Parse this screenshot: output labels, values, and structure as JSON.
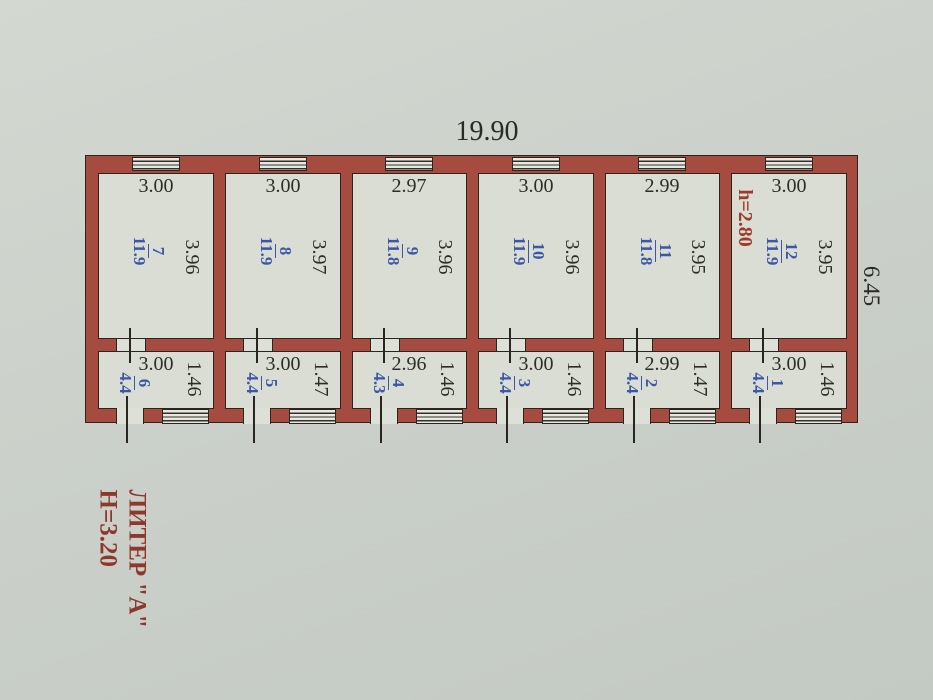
{
  "drawing": {
    "overall_width": "19.90",
    "overall_depth": "6.45",
    "ceiling_height_note": "h=2.80",
    "liter_label": "ЛИТЕР \"А\"",
    "building_height_note": "Н=3.20"
  },
  "top_rooms": [
    {
      "number": "7",
      "area": "11.9",
      "width": "3.00",
      "depth": "3.96"
    },
    {
      "number": "8",
      "area": "11.9",
      "width": "3.00",
      "depth": "3.97"
    },
    {
      "number": "9",
      "area": "11.8",
      "width": "2.97",
      "depth": "3.96"
    },
    {
      "number": "10",
      "area": "11.9",
      "width": "3.00",
      "depth": "3.96"
    },
    {
      "number": "11",
      "area": "11.8",
      "width": "2.99",
      "depth": "3.95"
    },
    {
      "number": "12",
      "area": "11.9",
      "width": "3.00",
      "depth": "3.95"
    }
  ],
  "bottom_rooms": [
    {
      "number": "6",
      "area": "4.4",
      "width": "3.00",
      "depth": "1.46"
    },
    {
      "number": "5",
      "area": "4.4",
      "width": "3.00",
      "depth": "1.47"
    },
    {
      "number": "4",
      "area": "4.3",
      "width": "2.96",
      "depth": "1.46"
    },
    {
      "number": "3",
      "area": "4.4",
      "width": "3.00",
      "depth": "1.46"
    },
    {
      "number": "2",
      "area": "4.4",
      "width": "2.99",
      "depth": "1.47"
    },
    {
      "number": "1",
      "area": "4.4",
      "width": "3.00",
      "depth": "1.46"
    }
  ],
  "colors": {
    "wall_red": "#a64b40",
    "room_label_blue": "#3d57a6",
    "note_red": "#9f392a",
    "paper": "#cbd1ca"
  }
}
